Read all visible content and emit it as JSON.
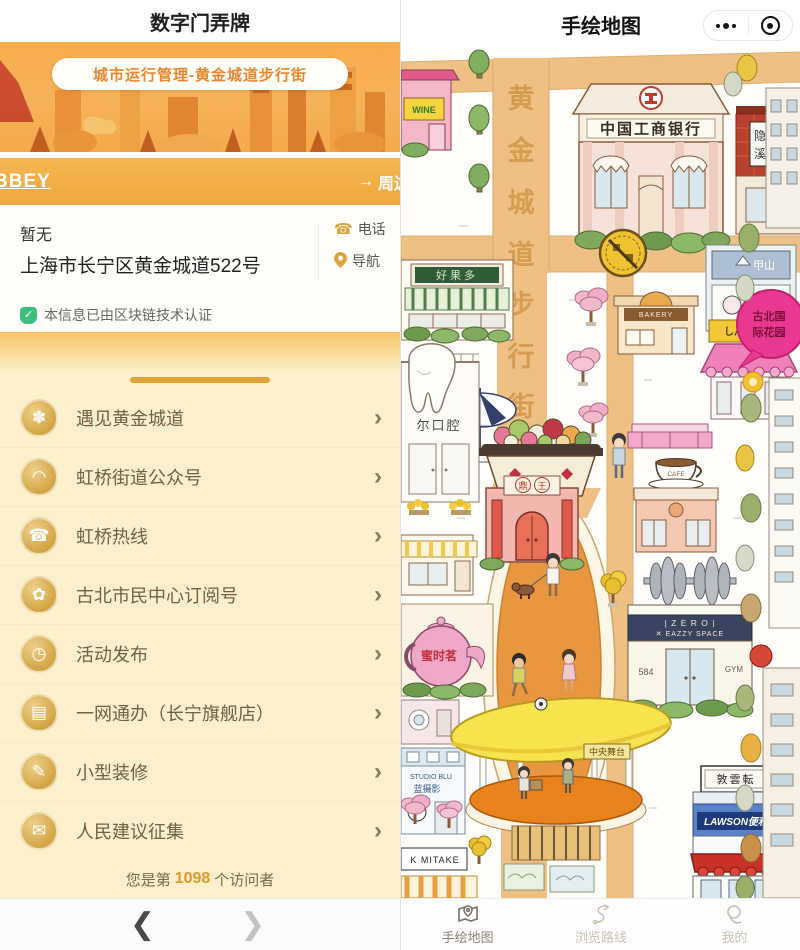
{
  "left_app": {
    "title": "数字门弄牌",
    "banner": {
      "pill_text": "城市运行管理-黄金城道步行街"
    },
    "orange_bar": {
      "left_text": "BBEY",
      "arrow": "→",
      "right_text": "周边"
    },
    "info": {
      "name": "暂无",
      "address": "上海市长宁区黄金城道522号",
      "phone_label": "电话",
      "phone_glyph": "☎",
      "nav_label": "导航",
      "cert_check": "✓",
      "cert_text": "本信息已由区块链技术认证"
    },
    "menu": [
      {
        "label": "遇见黄金城道",
        "icon": "maple-leaf-icon",
        "glyph": "✽"
      },
      {
        "label": "虹桥街道公众号",
        "icon": "rainbow-icon",
        "glyph": "◠"
      },
      {
        "label": "虹桥热线",
        "icon": "hotline-icon",
        "glyph": "☎"
      },
      {
        "label": "古北市民中心订阅号",
        "icon": "flower-icon",
        "glyph": "✿"
      },
      {
        "label": "活动发布",
        "icon": "clock-icon",
        "glyph": "◷"
      },
      {
        "label": "一网通办（长宁旗舰店）",
        "icon": "document-icon",
        "glyph": "▤"
      },
      {
        "label": "小型装修",
        "icon": "brush-icon",
        "glyph": "✎"
      },
      {
        "label": "人民建议征集",
        "icon": "comment-icon",
        "glyph": "✉"
      }
    ],
    "chevron": "›",
    "visitor": {
      "prefix": "您是第",
      "count": "1098",
      "suffix": "个访问者"
    },
    "nav_bar": {
      "back_glyph": "❮",
      "forward_glyph": "❯"
    }
  },
  "right_app": {
    "title": "手绘地图",
    "map": {
      "street": [
        "黄",
        "金",
        "城",
        "道",
        "步",
        "行",
        "街"
      ],
      "labels": {
        "bank": "中国工商银行",
        "wine": "WINE",
        "yinxi_1": "隐",
        "yinxi_2": "溪",
        "fruit": "好果多",
        "dental": "尔口腔",
        "bakery": "BAKERY",
        "jiashan": "甲山",
        "shinsen": "しんせん馆",
        "bubble_line1": "古北国",
        "bubble_line2": "际花园",
        "hotpot_1": "鼎",
        "hotpot_2": "王",
        "cafe": "CAFE",
        "tea": "蜜时茗",
        "gym_line1": "| Z E R O |",
        "gym_line2": "✕ EAZZY SPACE",
        "gym_num": "584",
        "gym": "GYM",
        "stage": "中央舞台",
        "studio1": "STUDIO BLU",
        "studio2": "蓝摄影",
        "mitake": "K MITAKE",
        "lawson_top": "敦雲転",
        "lawson": "LAWSON便利"
      }
    },
    "tabbar": [
      {
        "label": "手绘地图"
      },
      {
        "label": "浏览路线"
      },
      {
        "label": "我的"
      }
    ]
  },
  "colors": {
    "accent_orange": "#EFA83F",
    "cream": "#FBF0CB",
    "road_tan": "#EFC083",
    "cert_green": "#3DBE7B"
  }
}
